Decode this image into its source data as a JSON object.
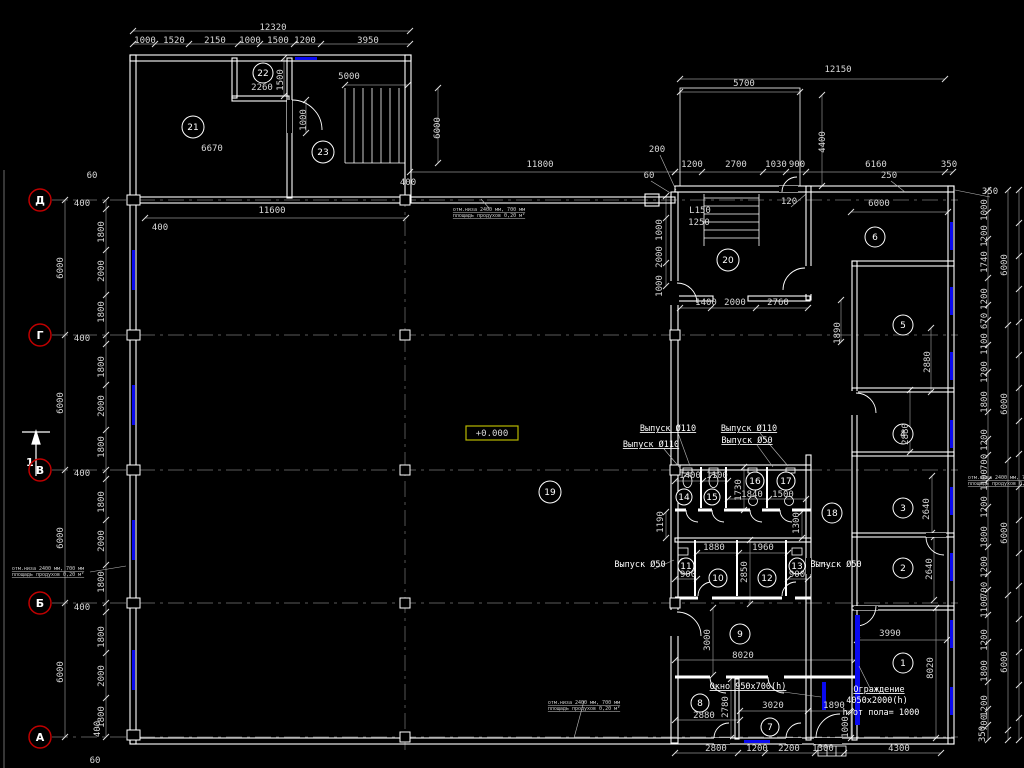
{
  "colors": {
    "background": "#000000",
    "line": "#ffffff",
    "dim_line": "#8f8f8f",
    "dim_text": "#d9d9d9",
    "axis_ring": "#c00000",
    "window_blue": "#0a0af0",
    "level_border": "#b8b800",
    "grid": "#787878"
  },
  "level_mark": {
    "text": "+0.000"
  },
  "section_marker": {
    "label": "1"
  },
  "axes": [
    {
      "label": "Д",
      "x": 40,
      "y": 200
    },
    {
      "label": "Г",
      "x": 40,
      "y": 335
    },
    {
      "label": "В",
      "x": 40,
      "y": 470
    },
    {
      "label": "Б",
      "x": 40,
      "y": 603
    },
    {
      "label": "А",
      "x": 40,
      "y": 737
    }
  ],
  "rooms": [
    {
      "n": "21",
      "x": 193,
      "y": 127,
      "r": 11
    },
    {
      "n": "22",
      "x": 263,
      "y": 73,
      "r": 10
    },
    {
      "n": "23",
      "x": 323,
      "y": 152,
      "r": 11
    },
    {
      "n": "20",
      "x": 728,
      "y": 260,
      "r": 11
    },
    {
      "n": "6",
      "x": 875,
      "y": 237,
      "r": 10
    },
    {
      "n": "5",
      "x": 903,
      "y": 325,
      "r": 10
    },
    {
      "n": "4",
      "x": 903,
      "y": 434,
      "r": 10
    },
    {
      "n": "3",
      "x": 903,
      "y": 508,
      "r": 10
    },
    {
      "n": "2",
      "x": 903,
      "y": 568,
      "r": 10
    },
    {
      "n": "1",
      "x": 903,
      "y": 663,
      "r": 10
    },
    {
      "n": "19",
      "x": 550,
      "y": 492,
      "r": 11
    },
    {
      "n": "18",
      "x": 832,
      "y": 513,
      "r": 10
    },
    {
      "n": "14",
      "x": 684,
      "y": 497,
      "r": 8
    },
    {
      "n": "15",
      "x": 712,
      "y": 497,
      "r": 8
    },
    {
      "n": "16",
      "x": 755,
      "y": 481,
      "r": 9
    },
    {
      "n": "17",
      "x": 786,
      "y": 481,
      "r": 9
    },
    {
      "n": "11",
      "x": 686,
      "y": 566,
      "r": 8
    },
    {
      "n": "10",
      "x": 718,
      "y": 578,
      "r": 9
    },
    {
      "n": "12",
      "x": 767,
      "y": 578,
      "r": 9
    },
    {
      "n": "13",
      "x": 797,
      "y": 566,
      "r": 8
    },
    {
      "n": "9",
      "x": 740,
      "y": 634,
      "r": 10
    },
    {
      "n": "8",
      "x": 700,
      "y": 703,
      "r": 9
    },
    {
      "n": "7",
      "x": 770,
      "y": 727,
      "r": 9
    }
  ],
  "dim_labels": [
    {
      "t": "1000",
      "x": 145,
      "y": 43
    },
    {
      "t": "1520",
      "x": 174,
      "y": 43
    },
    {
      "t": "2150",
      "x": 215,
      "y": 43
    },
    {
      "t": "1000",
      "x": 250,
      "y": 43
    },
    {
      "t": "1500",
      "x": 278,
      "y": 43
    },
    {
      "t": "1200",
      "x": 305,
      "y": 43
    },
    {
      "t": "3950",
      "x": 368,
      "y": 43
    },
    {
      "t": "12320",
      "x": 273,
      "y": 30
    },
    {
      "t": "2260",
      "x": 262,
      "y": 90
    },
    {
      "t": "1500",
      "x": 283,
      "y": 80,
      "r": 1
    },
    {
      "t": "5000",
      "x": 349,
      "y": 79
    },
    {
      "t": "6670",
      "x": 212,
      "y": 151
    },
    {
      "t": "1000",
      "x": 306,
      "y": 120,
      "r": 1
    },
    {
      "t": "6000",
      "x": 440,
      "y": 128,
      "r": 1
    },
    {
      "t": "400",
      "x": 408,
      "y": 185
    },
    {
      "t": "60",
      "x": 92,
      "y": 178
    },
    {
      "t": "400",
      "x": 82,
      "y": 206
    },
    {
      "t": "11600",
      "x": 272,
      "y": 213
    },
    {
      "t": "400",
      "x": 160,
      "y": 230
    },
    {
      "t": "11800",
      "x": 540,
      "y": 167
    },
    {
      "t": "1800",
      "x": 104,
      "y": 232,
      "r": 1
    },
    {
      "t": "2000",
      "x": 104,
      "y": 271,
      "r": 1
    },
    {
      "t": "1800",
      "x": 104,
      "y": 312,
      "r": 1
    },
    {
      "t": "6000",
      "x": 63,
      "y": 268,
      "r": 1
    },
    {
      "t": "400",
      "x": 82,
      "y": 341
    },
    {
      "t": "1800",
      "x": 104,
      "y": 367,
      "r": 1
    },
    {
      "t": "2000",
      "x": 104,
      "y": 406,
      "r": 1
    },
    {
      "t": "1800",
      "x": 104,
      "y": 447,
      "r": 1
    },
    {
      "t": "6000",
      "x": 63,
      "y": 403,
      "r": 1
    },
    {
      "t": "400",
      "x": 82,
      "y": 476
    },
    {
      "t": "1800",
      "x": 104,
      "y": 502,
      "r": 1
    },
    {
      "t": "2000",
      "x": 104,
      "y": 541,
      "r": 1
    },
    {
      "t": "1800",
      "x": 104,
      "y": 582,
      "r": 1
    },
    {
      "t": "6000",
      "x": 63,
      "y": 538,
      "r": 1
    },
    {
      "t": "400",
      "x": 82,
      "y": 610
    },
    {
      "t": "1800",
      "x": 104,
      "y": 637,
      "r": 1
    },
    {
      "t": "2000",
      "x": 104,
      "y": 676,
      "r": 1
    },
    {
      "t": "1800",
      "x": 104,
      "y": 717,
      "r": 1
    },
    {
      "t": "6000",
      "x": 63,
      "y": 672,
      "r": 1
    },
    {
      "t": "400",
      "x": 100,
      "y": 729,
      "r": 1
    },
    {
      "t": "60",
      "x": 95,
      "y": 763
    },
    {
      "t": "12150",
      "x": 838,
      "y": 72
    },
    {
      "t": "5700",
      "x": 744,
      "y": 86
    },
    {
      "t": "4400",
      "x": 825,
      "y": 142,
      "r": 1
    },
    {
      "t": "200",
      "x": 657,
      "y": 152
    },
    {
      "t": "60",
      "x": 649,
      "y": 178
    },
    {
      "t": "1200",
      "x": 692,
      "y": 167
    },
    {
      "t": "2700",
      "x": 736,
      "y": 167
    },
    {
      "t": "1030",
      "x": 776,
      "y": 167
    },
    {
      "t": "900",
      "x": 797,
      "y": 167
    },
    {
      "t": "6160",
      "x": 876,
      "y": 167
    },
    {
      "t": "350",
      "x": 949,
      "y": 167
    },
    {
      "t": "250",
      "x": 889,
      "y": 178
    },
    {
      "t": "120",
      "x": 789,
      "y": 204
    },
    {
      "t": "6000",
      "x": 879,
      "y": 206
    },
    {
      "t": "L150",
      "x": 700,
      "y": 213
    },
    {
      "t": "1250",
      "x": 699,
      "y": 225
    },
    {
      "t": "1000",
      "x": 662,
      "y": 230,
      "r": 1
    },
    {
      "t": "2000",
      "x": 662,
      "y": 257,
      "r": 1
    },
    {
      "t": "1000",
      "x": 662,
      "y": 286,
      "r": 1
    },
    {
      "t": "1400",
      "x": 706,
      "y": 305
    },
    {
      "t": "2000",
      "x": 735,
      "y": 305
    },
    {
      "t": "2760",
      "x": 778,
      "y": 305
    },
    {
      "t": "1890",
      "x": 840,
      "y": 333,
      "r": 1
    },
    {
      "t": "2880",
      "x": 930,
      "y": 362,
      "r": 1
    },
    {
      "t": "2880",
      "x": 908,
      "y": 434,
      "r": 1
    },
    {
      "t": "2640",
      "x": 929,
      "y": 509,
      "r": 1
    },
    {
      "t": "2640",
      "x": 932,
      "y": 569,
      "r": 1
    },
    {
      "t": "3990",
      "x": 890,
      "y": 636
    },
    {
      "t": "8020",
      "x": 933,
      "y": 668,
      "r": 1
    },
    {
      "t": "1400",
      "x": 690,
      "y": 478
    },
    {
      "t": "1100",
      "x": 717,
      "y": 478
    },
    {
      "t": "1730",
      "x": 741,
      "y": 490,
      "r": 1
    },
    {
      "t": "1840",
      "x": 752,
      "y": 497
    },
    {
      "t": "1500",
      "x": 783,
      "y": 497
    },
    {
      "t": "1190",
      "x": 663,
      "y": 522,
      "r": 1
    },
    {
      "t": "1300",
      "x": 799,
      "y": 523,
      "r": 1
    },
    {
      "t": "1880",
      "x": 714,
      "y": 550
    },
    {
      "t": "1960",
      "x": 763,
      "y": 550
    },
    {
      "t": "900",
      "x": 688,
      "y": 577
    },
    {
      "t": "900",
      "x": 797,
      "y": 577
    },
    {
      "t": "2850",
      "x": 747,
      "y": 572,
      "r": 1
    },
    {
      "t": "3000",
      "x": 710,
      "y": 640,
      "r": 1
    },
    {
      "t": "8020",
      "x": 743,
      "y": 658
    },
    {
      "t": "2880",
      "x": 704,
      "y": 718
    },
    {
      "t": "2780",
      "x": 728,
      "y": 707,
      "r": 1
    },
    {
      "t": "3020",
      "x": 773,
      "y": 708
    },
    {
      "t": "1890",
      "x": 834,
      "y": 708
    },
    {
      "t": "1000",
      "x": 848,
      "y": 727,
      "r": 1
    },
    {
      "t": "2800",
      "x": 716,
      "y": 751
    },
    {
      "t": "1200",
      "x": 757,
      "y": 751
    },
    {
      "t": "2200",
      "x": 789,
      "y": 751
    },
    {
      "t": "1300",
      "x": 823,
      "y": 751
    },
    {
      "t": "4300",
      "x": 899,
      "y": 751
    },
    {
      "t": "1000",
      "x": 987,
      "y": 210,
      "r": 1
    },
    {
      "t": "1200",
      "x": 987,
      "y": 236,
      "r": 1
    },
    {
      "t": "1740",
      "x": 987,
      "y": 262,
      "r": 1
    },
    {
      "t": "1200",
      "x": 987,
      "y": 299,
      "r": 1
    },
    {
      "t": "670",
      "x": 987,
      "y": 321,
      "r": 1
    },
    {
      "t": "1100",
      "x": 987,
      "y": 344,
      "r": 1
    },
    {
      "t": "1200",
      "x": 987,
      "y": 372,
      "r": 1
    },
    {
      "t": "1800",
      "x": 987,
      "y": 402,
      "r": 1
    },
    {
      "t": "1200",
      "x": 987,
      "y": 440,
      "r": 1
    },
    {
      "t": "700",
      "x": 987,
      "y": 462,
      "r": 1
    },
    {
      "t": "1100",
      "x": 987,
      "y": 480,
      "r": 1
    },
    {
      "t": "1200",
      "x": 987,
      "y": 507,
      "r": 1
    },
    {
      "t": "1800",
      "x": 987,
      "y": 537,
      "r": 1
    },
    {
      "t": "1200",
      "x": 987,
      "y": 567,
      "r": 1
    },
    {
      "t": "700",
      "x": 987,
      "y": 590,
      "r": 1
    },
    {
      "t": "1100",
      "x": 987,
      "y": 607,
      "r": 1
    },
    {
      "t": "1200",
      "x": 987,
      "y": 640,
      "r": 1
    },
    {
      "t": "1800",
      "x": 987,
      "y": 671,
      "r": 1
    },
    {
      "t": "1200",
      "x": 987,
      "y": 706,
      "r": 1
    },
    {
      "t": "700",
      "x": 987,
      "y": 723,
      "r": 1
    },
    {
      "t": "6000",
      "x": 1007,
      "y": 265,
      "r": 1
    },
    {
      "t": "6000",
      "x": 1007,
      "y": 404,
      "r": 1
    },
    {
      "t": "6000",
      "x": 1007,
      "y": 533,
      "r": 1
    },
    {
      "t": "6000",
      "x": 1007,
      "y": 662,
      "r": 1
    },
    {
      "t": "350",
      "x": 990,
      "y": 194
    },
    {
      "t": "350",
      "x": 985,
      "y": 734,
      "r": 1
    }
  ],
  "callouts": [
    {
      "t": "Выпуск Ø110",
      "x": 668,
      "y": 431,
      "ul": true
    },
    {
      "t": "Выпуск Ø110",
      "x": 651,
      "y": 447,
      "ul": true
    },
    {
      "t": "Выпуск Ø110",
      "x": 749,
      "y": 431,
      "ul": true
    },
    {
      "t": "Выпуск Ø50",
      "x": 747,
      "y": 443,
      "ul": true
    },
    {
      "t": "Выпуск Ø50",
      "x": 640,
      "y": 567,
      "ul": false
    },
    {
      "t": "Выпуск Ø50",
      "x": 836,
      "y": 567,
      "ul": false
    },
    {
      "t": "Окно 950x700(h)",
      "x": 748,
      "y": 689,
      "ul": true
    },
    {
      "t": "Ограждение",
      "x": 879,
      "y": 692,
      "ul": true
    },
    {
      "t": "4050x2000(h)",
      "x": 877,
      "y": 703,
      "ul": false
    },
    {
      "t": "h от пола= 1000",
      "x": 881,
      "y": 715,
      "ul": false
    }
  ],
  "tiny_notes": [
    {
      "l1": "отм.низа 2400 мм, 700 мм",
      "l2": "площадь продухов 0,20 м²",
      "x": 489,
      "y": 211
    },
    {
      "l1": "отм.низа 2400 мм, 700 мм",
      "l2": "площадь продухов 0,20 м²",
      "x": 48,
      "y": 570
    },
    {
      "l1": "отм.низа 2400 мм, 700 мм",
      "l2": "площадь продухов 0,20 м²",
      "x": 584,
      "y": 704
    },
    {
      "l1": "отм.низа 2400 мм, 700 мм",
      "l2": "площадь продухов 0,20 м²",
      "x": 1004,
      "y": 479
    }
  ]
}
